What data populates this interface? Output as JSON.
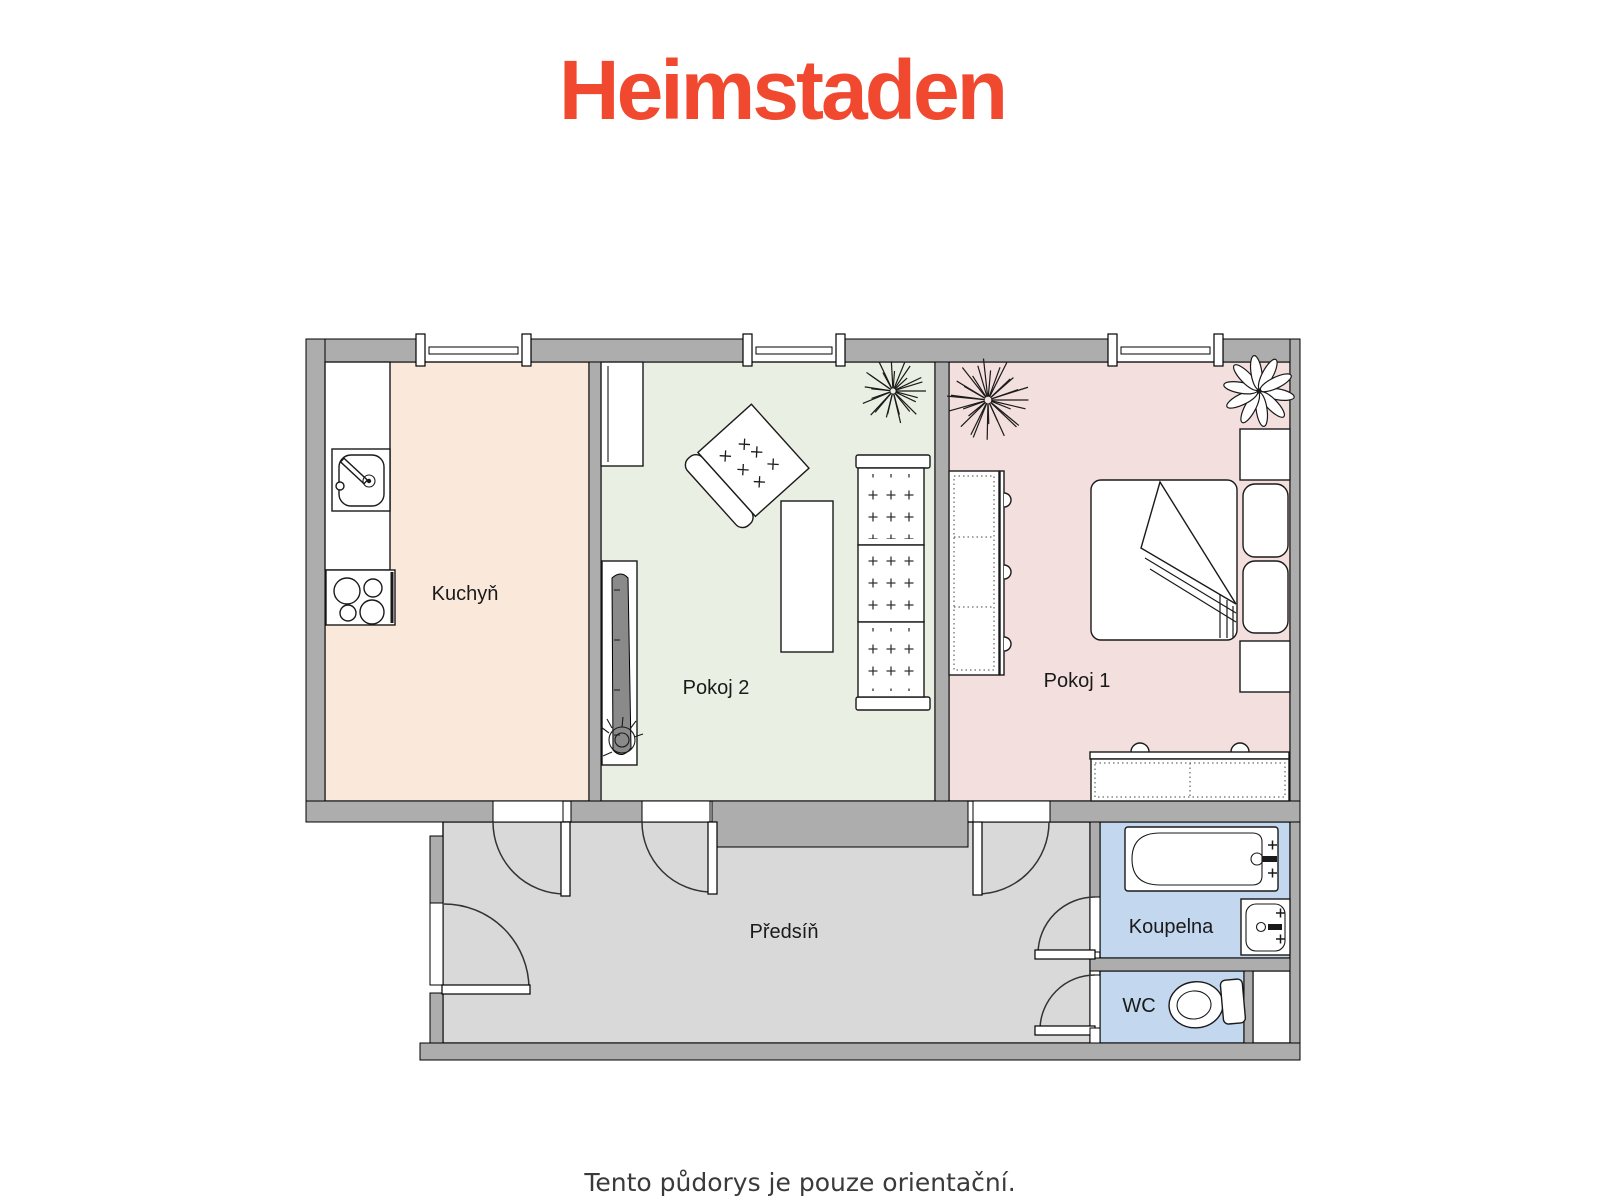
{
  "header": {
    "logo_text": "Heimstaden"
  },
  "rooms": {
    "kuchyn": {
      "label": "Kuchyň"
    },
    "pokoj2": {
      "label": "Pokoj 2"
    },
    "pokoj1": {
      "label": "Pokoj 1"
    },
    "predsin": {
      "label": "Předsíň"
    },
    "koupelna": {
      "label": "Koupelna"
    },
    "wc": {
      "label": "WC"
    }
  },
  "footer": {
    "disclaimer": "Tento půdorys je pouze orientační."
  },
  "colors": {
    "logo": "#F1492F",
    "wall": "#ADADAD",
    "kuchyn": "#FAE8DB",
    "pokoj2": "#E9EFE2",
    "pokoj1": "#F3DFDE",
    "predsin": "#D9D9D9",
    "koupelna": "#C3D7EE",
    "wc": "#C3D7EE",
    "label": "#1A1A1A",
    "caption": "#3A3A3A"
  }
}
